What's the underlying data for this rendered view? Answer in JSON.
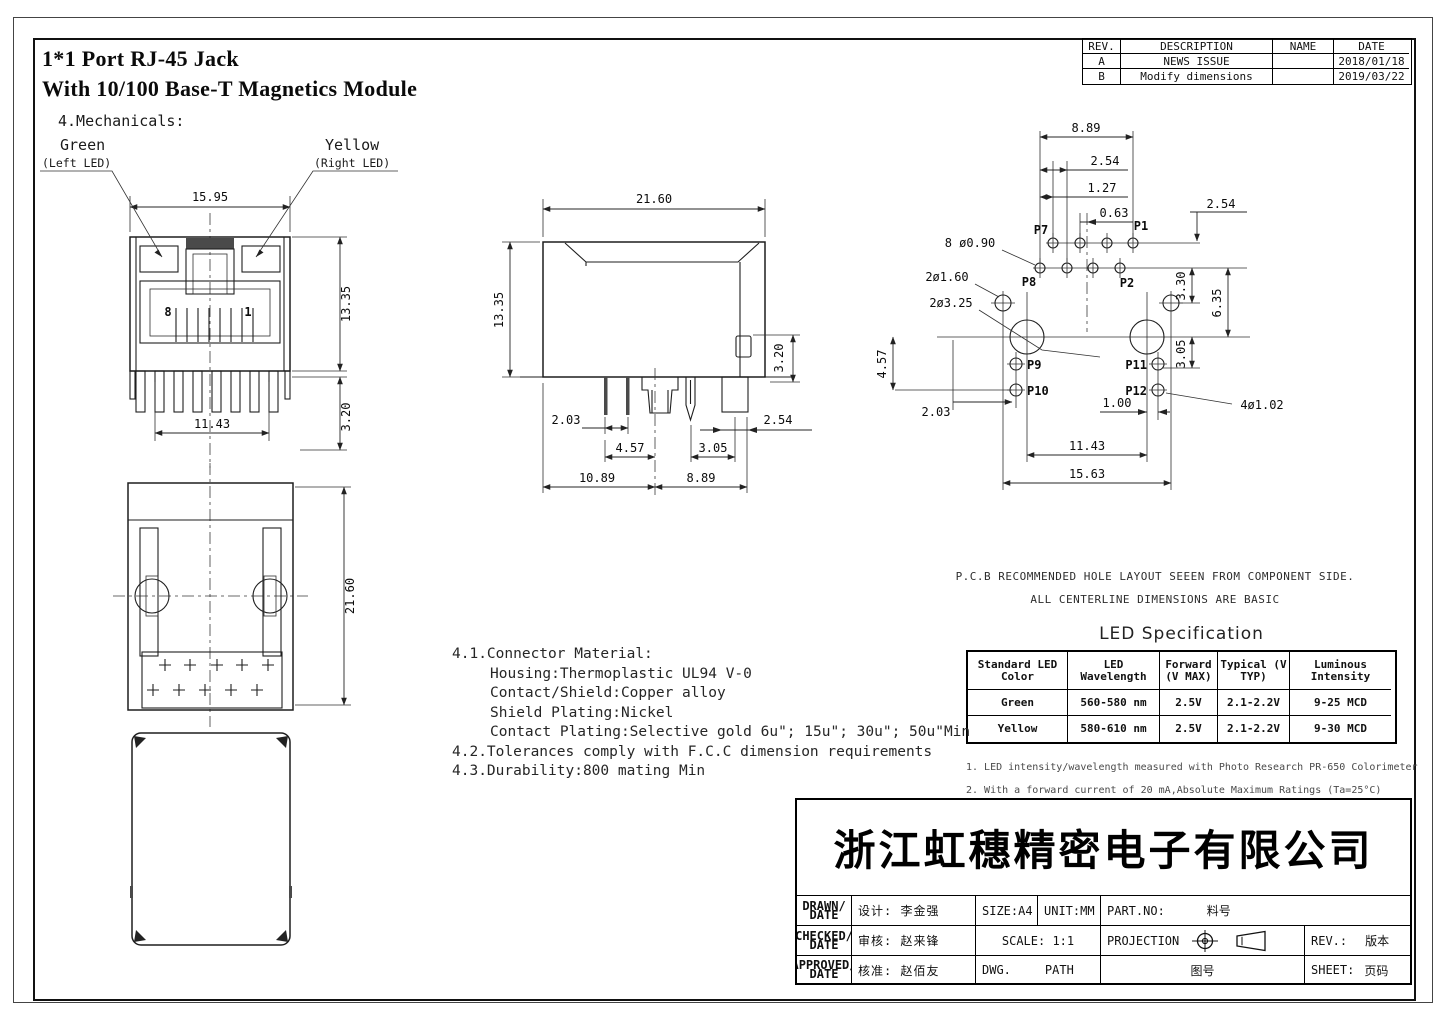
{
  "title": {
    "line1": "1*1 Port RJ-45  Jack",
    "line2": "With 10/100 Base-T Magnetics Module",
    "section": "4.Mechanicals:"
  },
  "revision_table": {
    "headers": {
      "rev": "REV.",
      "description": "DESCRIPTION",
      "name": "NAME",
      "date": "DATE"
    },
    "rows": [
      {
        "rev": "A",
        "description": "NEWS ISSUE",
        "name": "",
        "date": "2018/01/18"
      },
      {
        "rev": "B",
        "description": "Modify dimensions",
        "name": "",
        "date": "2019/03/22"
      }
    ]
  },
  "front": {
    "d_1595": "15.95",
    "d_1335": "13.35",
    "d_1143": "11.43",
    "d_320": "3.20",
    "pin8": "8",
    "pin1": "1",
    "green": "Green",
    "green_sub": "(Left LED)",
    "yellow": "Yellow",
    "yellow_sub": "(Right LED)"
  },
  "side": {
    "d_2160": "21.60",
    "d_1335": "13.35",
    "d_320": "3.20",
    "d_203": "2.03",
    "d_457": "4.57",
    "d_305": "3.05",
    "d_254": "2.54",
    "d_1089": "10.89",
    "d_889": "8.89"
  },
  "bottom": {
    "d_2160": "21.60"
  },
  "pcb": {
    "d_889": "8.89",
    "d_254_top": "2.54",
    "d_127": "1.27",
    "d_063": "0.63",
    "d_254_right": "2.54",
    "label_8holes": "8 ø0.90",
    "label_2holes_160": "2ø1.60",
    "label_2holes_325": "2ø3.25",
    "d_457": "4.57",
    "d_203": "2.03",
    "d_330": "3.30",
    "d_635": "6.35",
    "d_305": "3.05",
    "d_100": "1.00",
    "label_4holes": "4ø1.02",
    "d_1143": "11.43",
    "d_1563": "15.63",
    "p1": "P1",
    "p2": "P2",
    "p7": "P7",
    "p8": "P8",
    "p9": "P9",
    "p10": "P10",
    "p11": "P11",
    "p12": "P12",
    "note1": "P.C.B RECOMMENDED HOLE LAYOUT SEEEN FROM COMPONENT SIDE.",
    "note2": "ALL CENTERLINE DIMENSIONS ARE BASIC"
  },
  "notes": {
    "n41": "4.1.Connector Material:",
    "n41a": "Housing:Thermoplastic UL94 V-0",
    "n41b": "Contact/Shield:Copper alloy",
    "n41c": "Shield Plating:Nickel",
    "n41d": "Contact Plating:Selective gold 6u\"; 15u\"; 30u\"; 50u\"Min",
    "n42": "4.2.Tolerances comply with F.C.C dimension requirements",
    "n43": "4.3.Durability:800 mating Min"
  },
  "led_table": {
    "title": "LED Specification",
    "headers": [
      "Standard LED Color",
      "LED Wavelength",
      "Forward (V MAX)",
      "Typical (V TYP)",
      "Luminous Intensity"
    ],
    "rows": [
      [
        "Green",
        "560-580 nm",
        "2.5V",
        "2.1-2.2V",
        "9-25 MCD"
      ],
      [
        "Yellow",
        "580-610 nm",
        "2.5V",
        "2.1-2.2V",
        "9-30 MCD"
      ]
    ],
    "footnote1": "1. LED intensity/wavelength measured with Photo Research PR-650 Colorimeter",
    "footnote2": "2. With a forward current of 20 mA,Absolute Maximum Ratings (Ta=25°C)"
  },
  "title_block": {
    "company": "浙江虹穗精密电子有限公司",
    "drawn": "DRAWN/",
    "checked": "CHECKED/",
    "approved": "APPROVED/",
    "date_word": "DATE",
    "designer": "设计: 李金强",
    "checker": "审核: 赵来锋",
    "approver": "核准: 赵佰友",
    "size": "SIZE:A4",
    "unit": "UNIT:MM",
    "part_no": "PART.NO:",
    "part_no_value": "料号",
    "scale": "SCALE: 1:1",
    "projection": "PROJECTION",
    "rev": "REV.:",
    "rev_value": "版本",
    "dwg": "DWG.",
    "path": "PATH",
    "dwg_no": "图号",
    "sheet": "SHEET:",
    "sheet_value": "页码"
  }
}
